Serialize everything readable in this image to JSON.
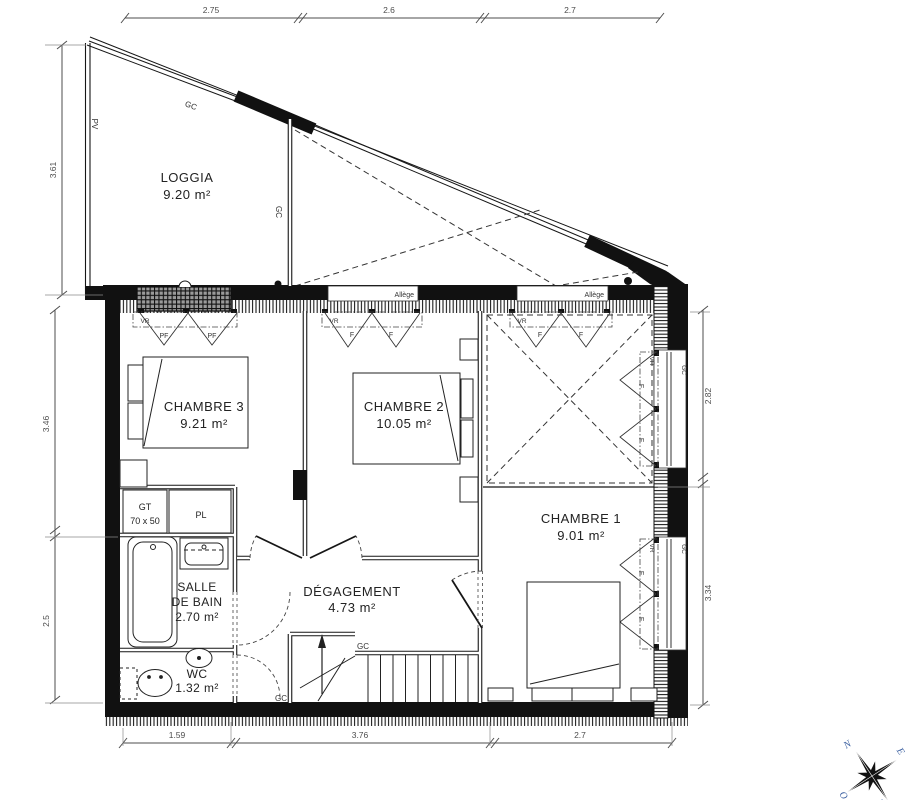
{
  "rooms": {
    "loggia": {
      "name": "LOGGIA",
      "area": "9.20 m²"
    },
    "chambre3": {
      "name": "CHAMBRE 3",
      "area": "9.21 m²"
    },
    "chambre2": {
      "name": "CHAMBRE 2",
      "area": "10.05 m²"
    },
    "chambre1": {
      "name": "CHAMBRE 1",
      "area": "9.01 m²"
    },
    "salle_de_bain": {
      "line1": "SALLE",
      "line2": "DE BAIN",
      "area": "2.70 m²"
    },
    "degagement": {
      "name": "DÉGAGEMENT",
      "area": "4.73 m²"
    },
    "wc": {
      "name": "WC",
      "area": "1.32 m²"
    }
  },
  "dimensions": {
    "top": [
      "2.75",
      "2.6",
      "2.7"
    ],
    "left": [
      "3.61",
      "3.46",
      "2.5"
    ],
    "right": [
      "2.82",
      "3.34"
    ],
    "bottom": [
      "1.59",
      "3.76",
      "2.7"
    ]
  },
  "annotations": {
    "gc": "GC",
    "pv": "PV",
    "vr": "VR",
    "pf": "PF",
    "f": "F",
    "allege": "Allège",
    "gt": "GT",
    "gt_size": "70 x 50",
    "pl": "PL"
  },
  "compass": {
    "n": "N",
    "e": "E",
    "s": "S",
    "o": "O"
  },
  "colors": {
    "line": "#161616",
    "dim": "#4d4d4d",
    "compass_letter": "#3a5fa0"
  }
}
